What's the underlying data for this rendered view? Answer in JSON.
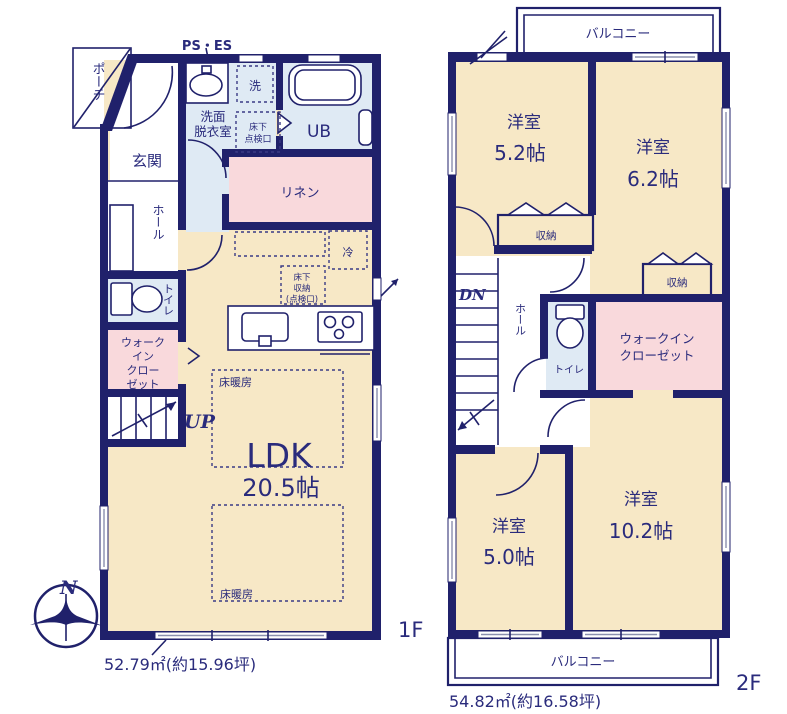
{
  "title": "戸建て間取り図 1F・2F",
  "colors": {
    "wall_navy": "#20216b",
    "text_navy": "#2a2b7c",
    "room_beige": "#f7e8c6",
    "room_pink": "#f9d9dc",
    "room_blue": "#dfeaf4",
    "room_white": "#ffffff"
  },
  "compass": {
    "north_label": "N"
  },
  "floor1": {
    "floor_label": "1F",
    "area_text": "52.79㎡(約15.96坪)",
    "ps_es": "PS・ES",
    "porch": "ポーチ",
    "genkan": "玄関",
    "hall": "ホール",
    "toilet": "トイレ",
    "wic_l1": "ウォーク",
    "wic_l2": "イン",
    "wic_l3": "クロー",
    "wic_l4": "ゼット",
    "washroom_l1": "洗面",
    "washroom_l2": "脱衣室",
    "laundry": "洗",
    "inspection_l1": "床下",
    "inspection_l2": "点検口",
    "unit_bath": "UB",
    "linen": "リネン",
    "fridge": "冷",
    "underfloor_l1": "床下",
    "underfloor_l2": "収納",
    "underfloor_l3": "(点検口)",
    "floor_heating_1": "床暖房",
    "floor_heating_2": "床暖房",
    "ldk": "LDK",
    "ldk_size": "20.5帖",
    "up": "UP"
  },
  "floor2": {
    "floor_label": "2F",
    "area_text": "54.82㎡(約16.58坪)",
    "balcony_top": "バルコニー",
    "balcony_bottom": "バルコニー",
    "room52_name": "洋室",
    "room52_size": "5.2帖",
    "room62_name": "洋室",
    "room62_size": "6.2帖",
    "storage1": "収納",
    "storage2": "収納",
    "dn": "DN",
    "hall": "ホール",
    "toilet": "トイレ",
    "wic_l1": "ウォークイン",
    "wic_l2": "クローゼット",
    "room50_name": "洋室",
    "room50_size": "5.0帖",
    "room102_name": "洋室",
    "room102_size": "10.2帖"
  }
}
